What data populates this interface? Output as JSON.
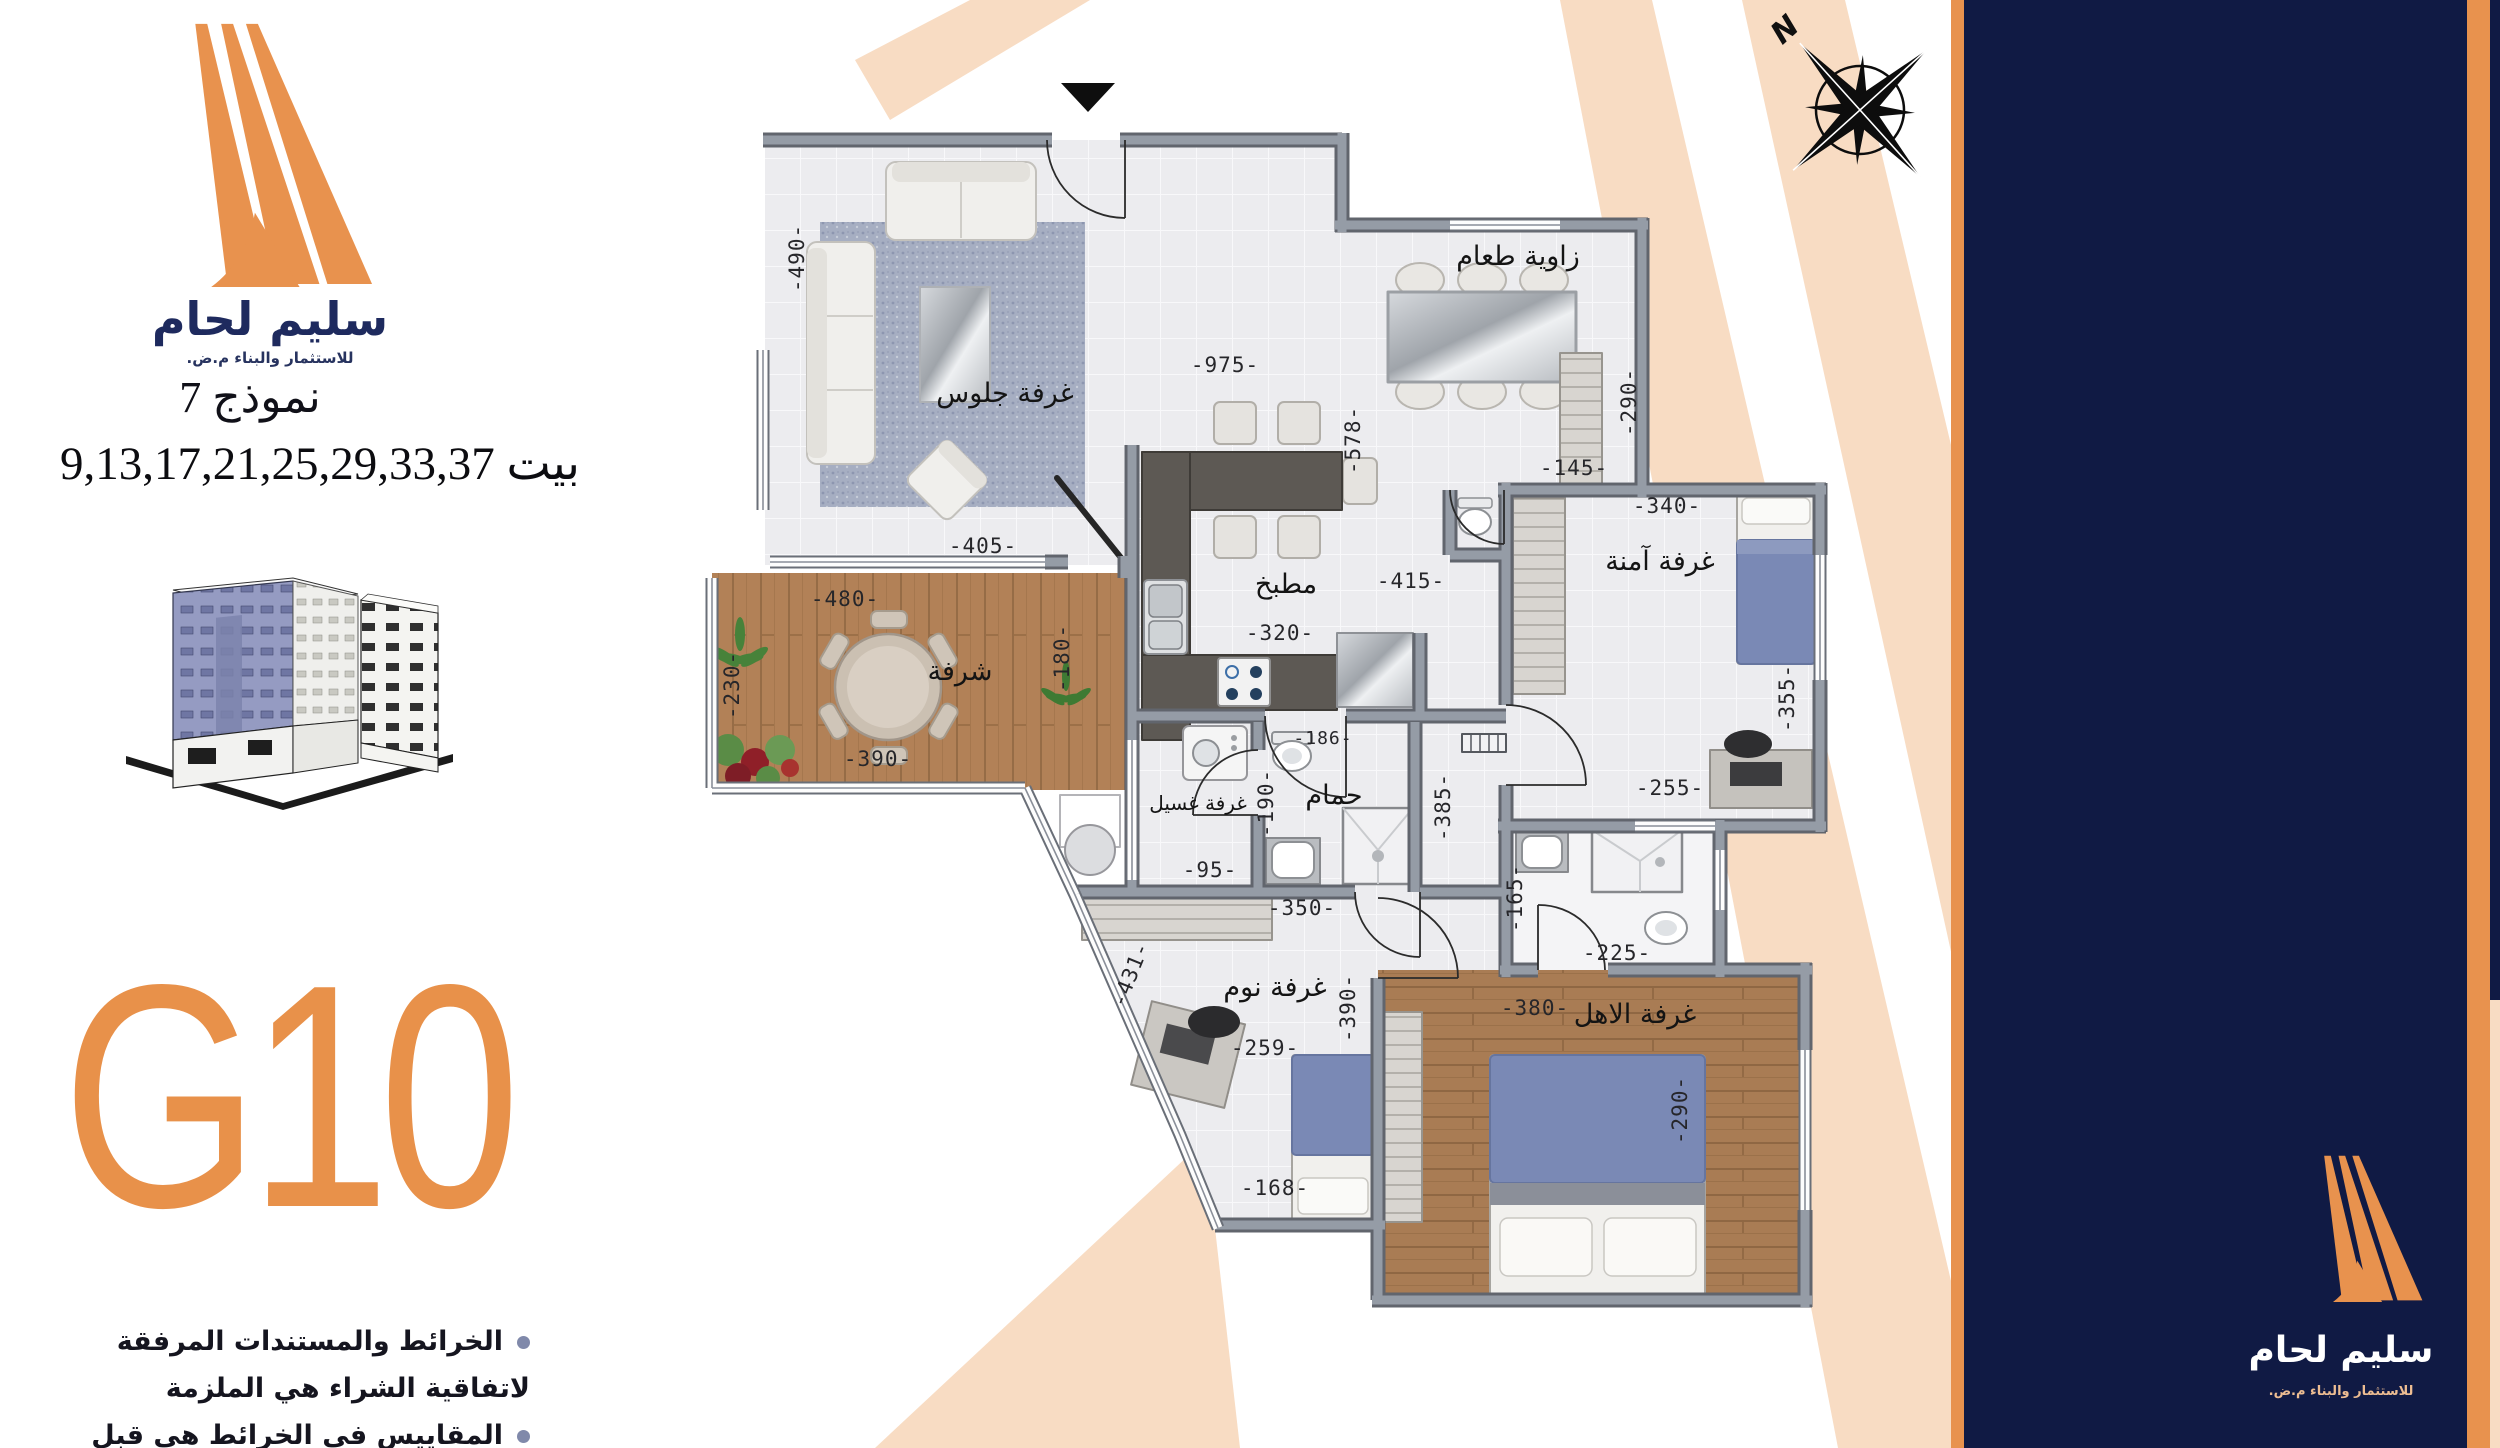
{
  "brand": {
    "name": "سليم لحام",
    "tagline": "للاستثمار والبناء م.ض.",
    "accent_orange": "#E8924E",
    "navy": "#101A44",
    "peach": "#F8DCC3"
  },
  "unit": {
    "model_label": "نموذج 7",
    "houses_label": "بيت 9,13,17,21,25,29,33,37",
    "code": "G10"
  },
  "notes": [
    "الخرائط والمستندات المرفقة لاتفاقية الشراء هي الملزمة",
    "المقاييس في الخرائط هي قبل مرحلة القصارة"
  ],
  "compass": {
    "north_label": "N"
  },
  "side_panel_brand": {
    "name": "سليم لحام",
    "tagline": "للاستثمار والبناء م.ض."
  },
  "plan": {
    "rooms": {
      "living": "غرفة جلوس",
      "dining": "زاوية طعام",
      "kitchen": "مطبخ",
      "balcony": "شرفة",
      "laundry": "غرفة غسيل",
      "bath": "حمام",
      "safe": "غرفة آمنة",
      "bedroom": "غرفة نوم",
      "family": "غرفة الاهل"
    },
    "dims": {
      "living_h": "-490-",
      "living_w": "-405-",
      "balcony_w": "-480-",
      "balcony_w2": "-390-",
      "balcony_l": "-230-",
      "balcony_r": "-180-",
      "hall_w": "-975-",
      "kitchen_h": "-578-",
      "kitchen_w": "-320-",
      "kitchen_w2": "-415-",
      "kitchen_wc": "-186-",
      "laundry_w": "-95-",
      "laundry_h": "-190-",
      "hall_h": "-385-",
      "dining_h": "-290-",
      "dining_w": "-145-",
      "safe_w": "-340-",
      "safe_h": "-355-",
      "safe_w2": "-255-",
      "bath2_h": "-165-",
      "bath2_w": "-225-",
      "family_w": "-380-",
      "family_h": "-290-",
      "bedroom_w": "-350-",
      "bedroom_h": "-390-",
      "bedroom_w2": "-259-",
      "bedroom_w3": "-168-",
      "bedroom_angled": "-431-"
    }
  }
}
